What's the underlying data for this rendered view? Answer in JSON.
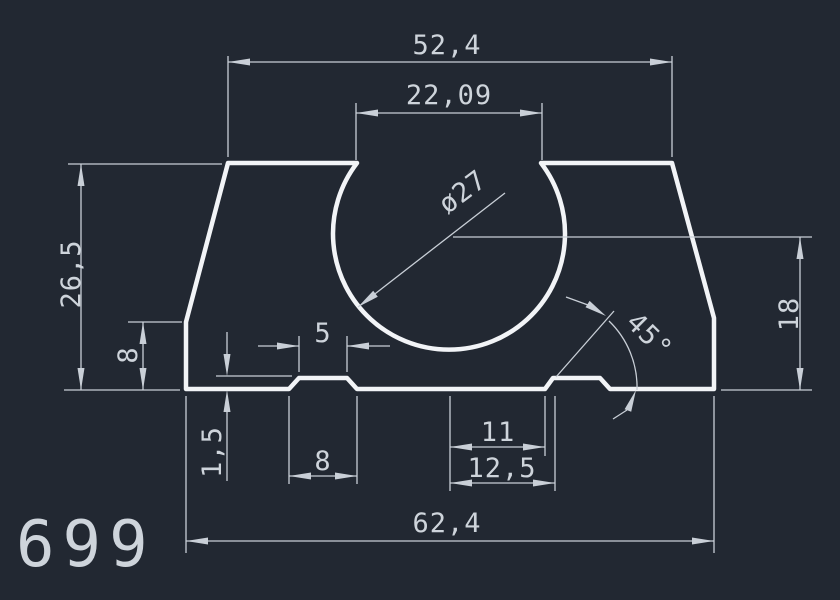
{
  "drawing": {
    "part_number": "699",
    "dims": {
      "top_width": {
        "label": "52,4",
        "value": 52.4
      },
      "opening_width": {
        "label": "22,09",
        "value": 22.09
      },
      "bore_diameter": {
        "label": "ø27",
        "value": 27
      },
      "overall_height": {
        "label": "26,5",
        "value": 26.5
      },
      "left_shoulder_height": {
        "label": "8",
        "value": 8
      },
      "groove_depth": {
        "label": "1,5",
        "value": 1.5
      },
      "left_groove_top_width": {
        "label": "5",
        "value": 5
      },
      "left_groove_bottom_width": {
        "label": "8",
        "value": 8
      },
      "right_groove_offset_near": {
        "label": "11",
        "value": 11
      },
      "right_groove_offset_far": {
        "label": "12,5",
        "value": 12.5
      },
      "bottom_width": {
        "label": "62,4",
        "value": 62.4
      },
      "bore_center_height": {
        "label": "18",
        "value": 18
      },
      "chamfer_angle": {
        "label": "45°",
        "value": 45
      }
    }
  },
  "colors": {
    "background": "#222832",
    "outline": "#f2f4f7",
    "dimension_lines": "#c9cfd7",
    "text": "#ced4db"
  }
}
